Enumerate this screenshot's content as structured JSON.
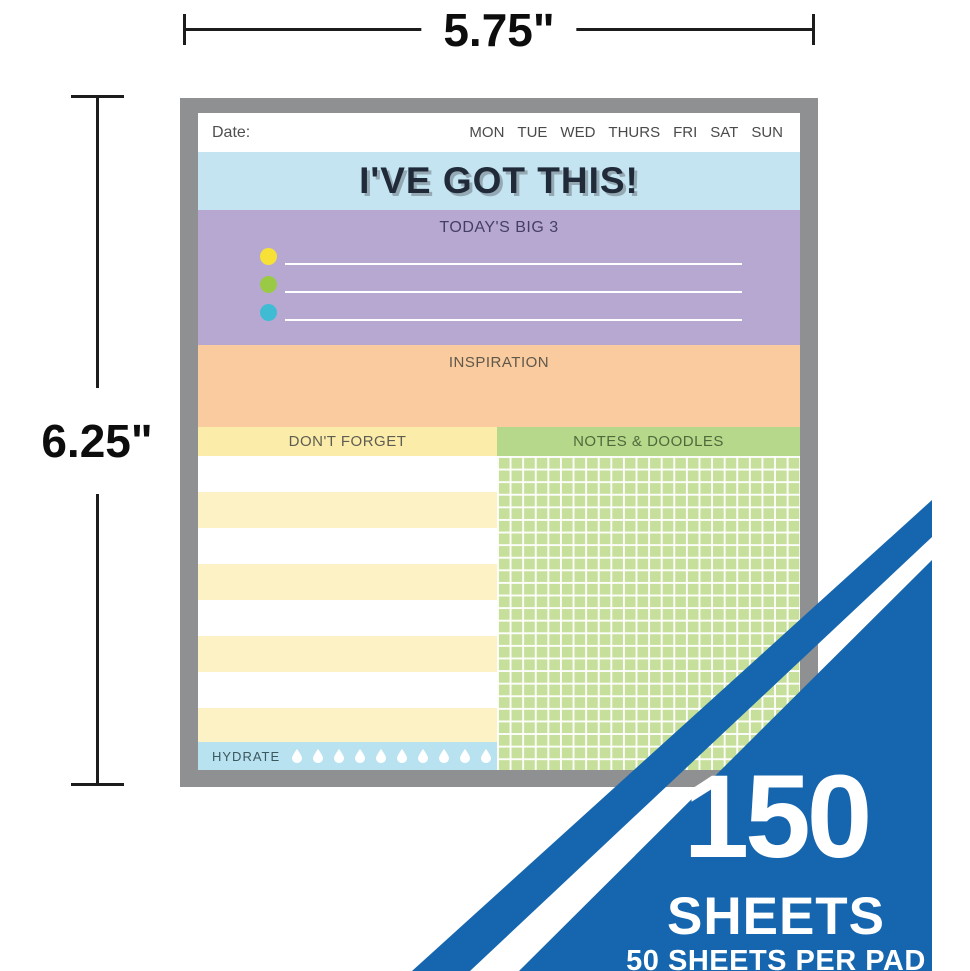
{
  "annotation": {
    "width_label": "5.75\"",
    "height_label": "6.25\""
  },
  "pad": {
    "header": {
      "date_label": "Date:",
      "days": [
        "MON",
        "TUE",
        "WED",
        "THURS",
        "FRI",
        "SAT",
        "SUN"
      ]
    },
    "title": "I'VE GOT THIS!",
    "big3": {
      "heading": "TODAY'S BIG 3",
      "bullets": [
        {
          "name": "yellow",
          "color": "#f8e136"
        },
        {
          "name": "green",
          "color": "#9aca45"
        },
        {
          "name": "blue",
          "color": "#3fbcd4"
        }
      ]
    },
    "inspiration": {
      "heading": "INSPIRATION"
    },
    "dont_forget": {
      "heading": "DON'T FORGET"
    },
    "notes_doodles": {
      "heading": "NOTES & DOODLES"
    },
    "hydrate": {
      "heading": "HYDRATE",
      "drop_count": 10
    },
    "colors": {
      "frame": "#8e9092",
      "title_band": "#c3e4f0",
      "big3_band": "#b7a8d2",
      "inspiration_band": "#f9cb9e",
      "dont_forget_band": "#fcecaa",
      "notes_band": "#b5d88b",
      "hydrate_band": "#b9e2f0"
    }
  },
  "badge": {
    "count": "150",
    "unit": "SHEETS",
    "sublabel": "50 SHEETS PER PAD",
    "color": "#1566ae"
  }
}
